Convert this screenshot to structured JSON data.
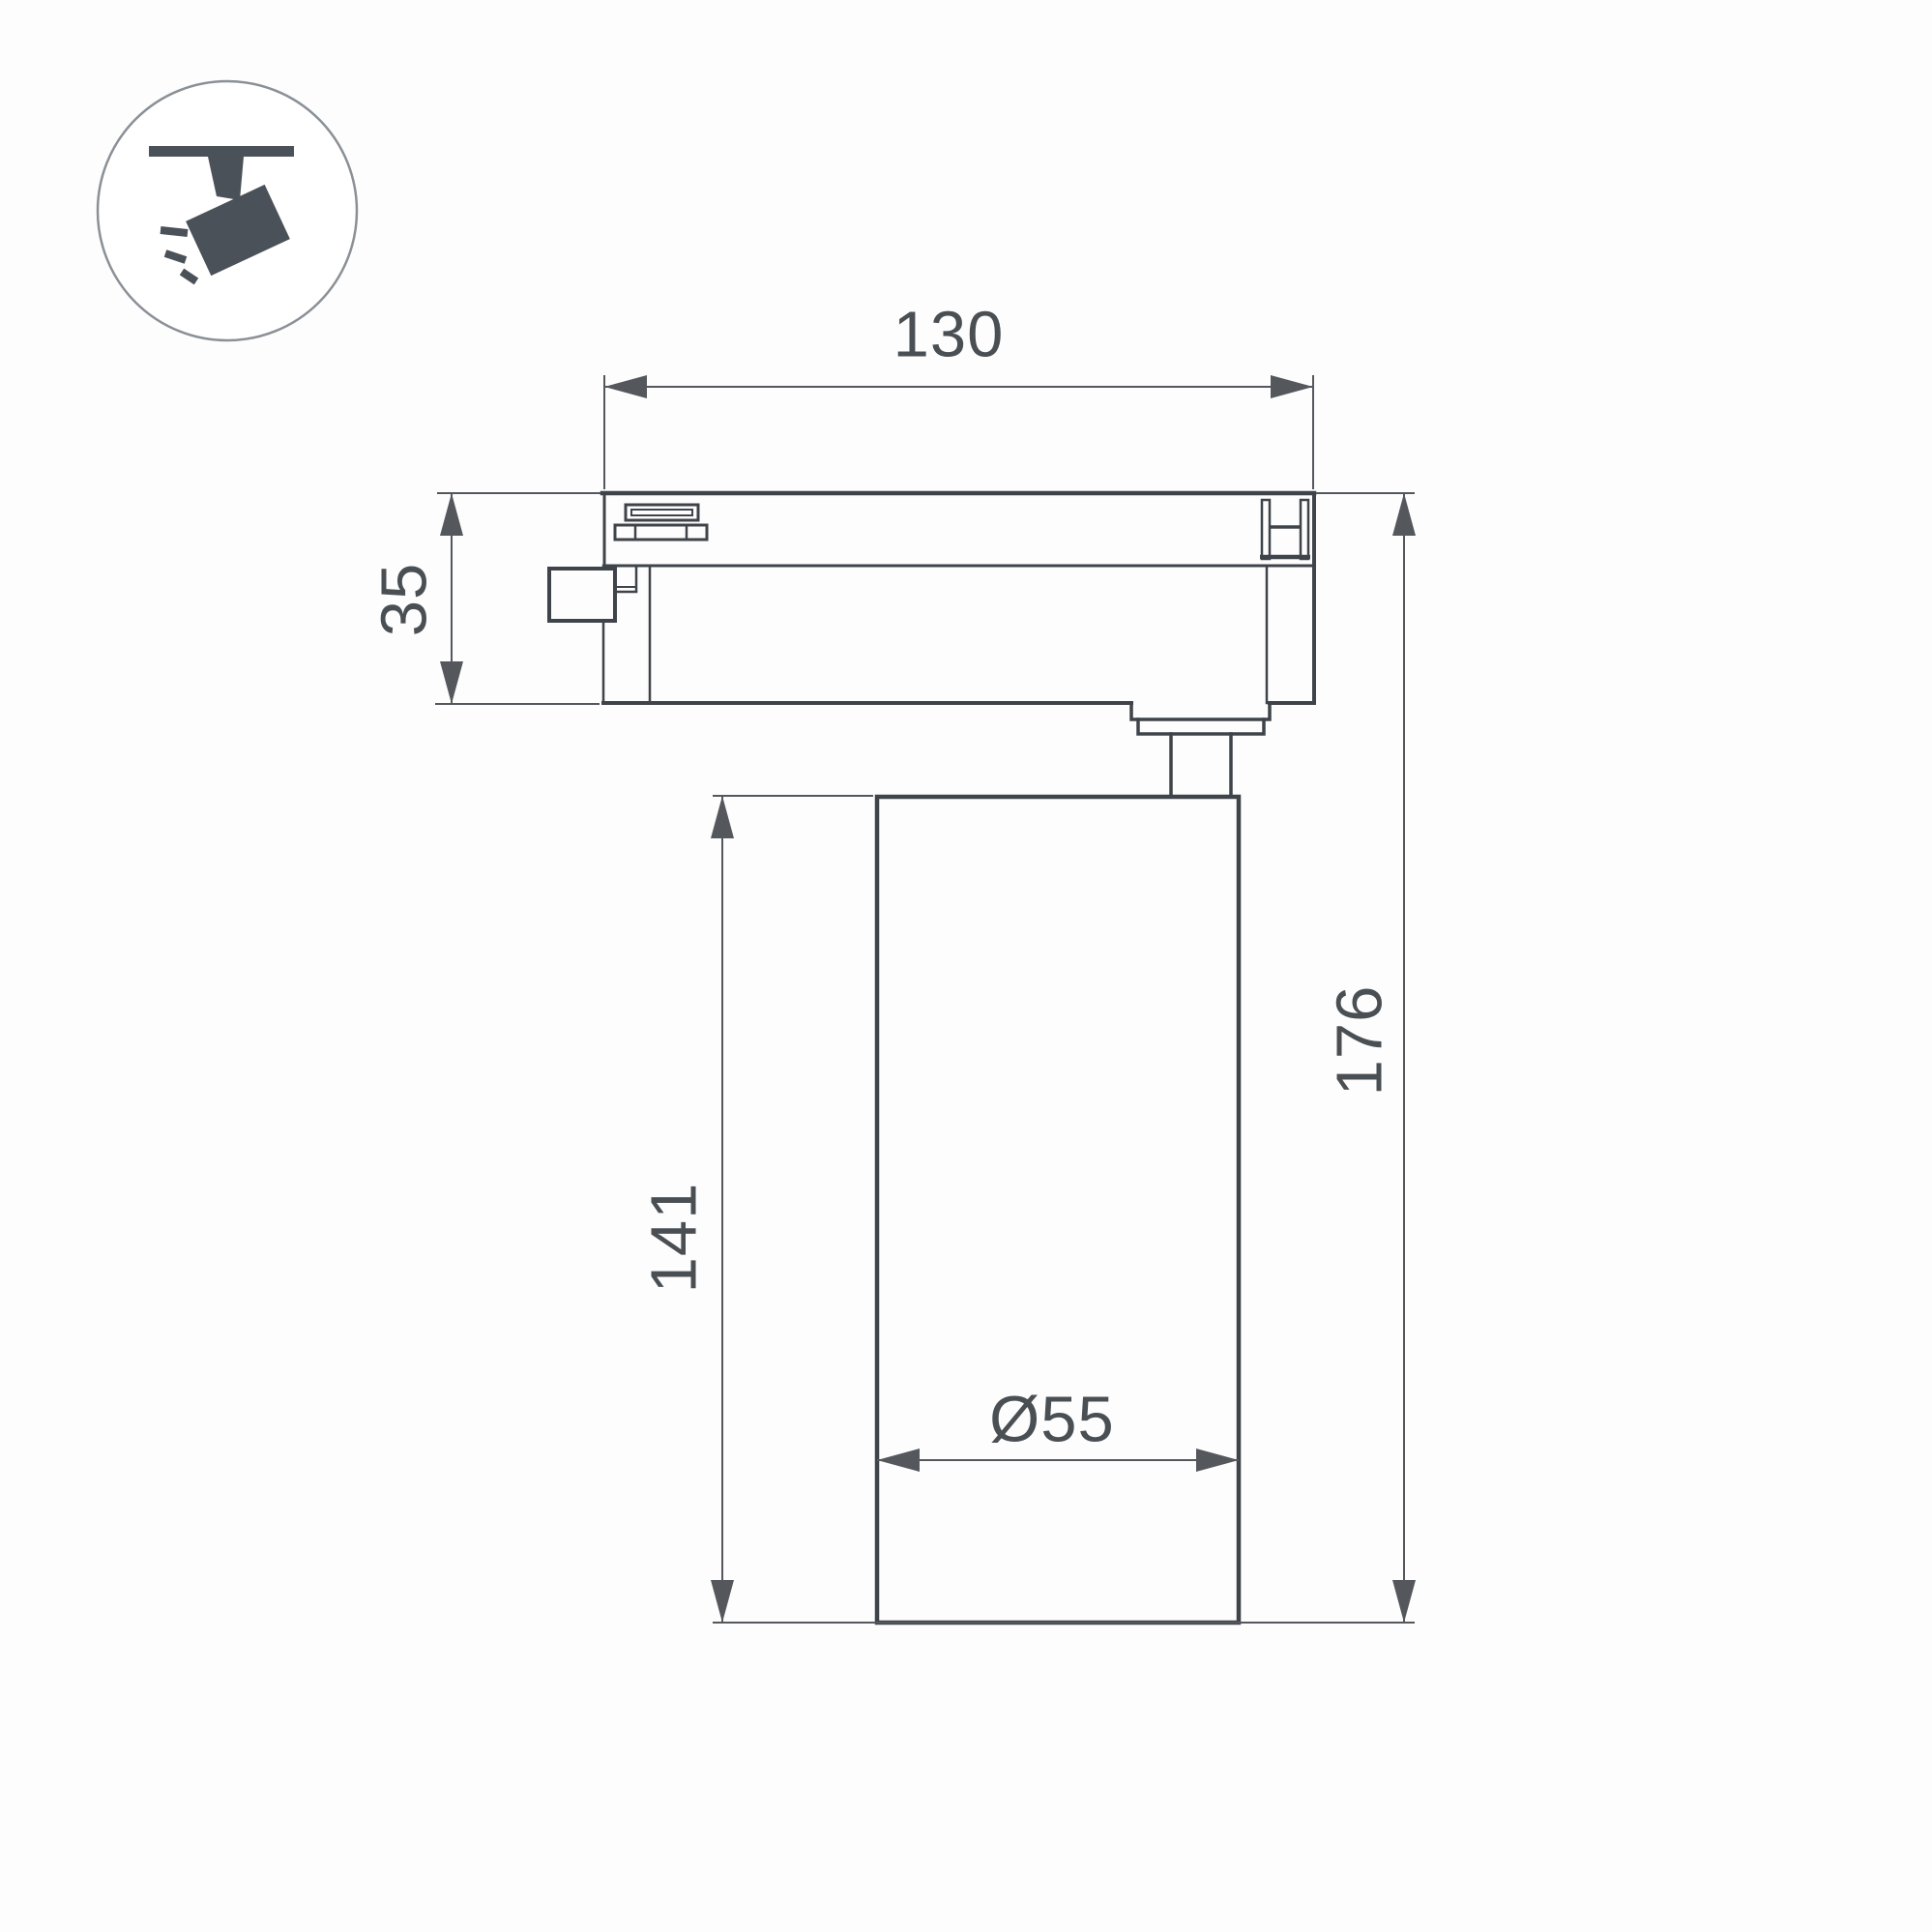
{
  "figure": {
    "type": "technical-dimension-drawing",
    "subject": "led-track-spotlight-side-view",
    "dimensions": {
      "track_width": "130",
      "adapter_height": "35",
      "body_height": "141",
      "total_height": "176",
      "diameter": "Ø55"
    },
    "icon": {
      "name": "track-spotlight-icon",
      "description": "tilted spotlight hanging from ceiling track with light rays"
    },
    "colors": {
      "outline": "#3f444a",
      "dimension_line": "#54585d",
      "label_text": "#4a4f54",
      "icon_fill": "#4b5158",
      "icon_circle_stroke": "#8a9096",
      "background": "#fdfdfd"
    }
  }
}
